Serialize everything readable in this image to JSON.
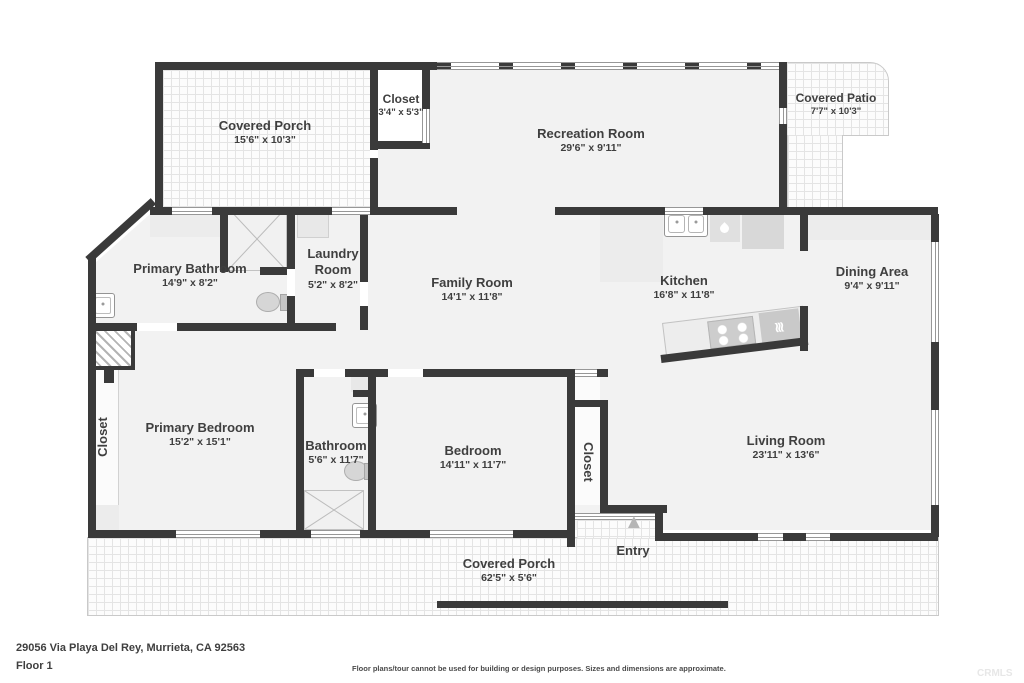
{
  "rooms": {
    "covered_porch_top": {
      "name": "Covered Porch",
      "dims": "15'6\" x 10'3\""
    },
    "closet_top": {
      "name": "Closet",
      "dims": "3'4\" x 5'3\""
    },
    "recreation_room": {
      "name": "Recreation Room",
      "dims": "29'6\" x 9'11\""
    },
    "covered_patio": {
      "name": "Covered Patio",
      "dims": "7'7\" x 10'3\""
    },
    "primary_bathroom": {
      "name": "Primary Bathroom",
      "dims": "14'9\" x 8'2\""
    },
    "laundry_room": {
      "name": "Laundry Room",
      "dims": "5'2\" x 8'2\""
    },
    "family_room": {
      "name": "Family Room",
      "dims": "14'1\" x 11'8\""
    },
    "kitchen": {
      "name": "Kitchen",
      "dims": "16'8\" x 11'8\""
    },
    "dining_area": {
      "name": "Dining Area",
      "dims": "9'4\" x 9'11\""
    },
    "closet_left": {
      "name": "Closet"
    },
    "primary_bedroom": {
      "name": "Primary Bedroom",
      "dims": "15'2\" x 15'1\""
    },
    "bathroom": {
      "name": "Bathroom",
      "dims": "5'6\" x 11'7\""
    },
    "bedroom": {
      "name": "Bedroom",
      "dims": "14'11\" x 11'7\""
    },
    "closet_bedroom": {
      "name": "Closet"
    },
    "living_room": {
      "name": "Living Room",
      "dims": "23'11\" x 13'6\""
    },
    "entry": {
      "name": "Entry"
    },
    "covered_porch_bottom": {
      "name": "Covered Porch",
      "dims": "62'5\" x 5'6\""
    }
  },
  "footer": {
    "address": "29056 Via Playa Del Rey, Murrieta, CA 92563",
    "floor_label": "Floor 1",
    "disclaimer": "Floor plans/tour cannot be used for building or design purposes. Sizes and dimensions are approximate.",
    "watermark": "CRMLS"
  },
  "icons": {
    "entry_arrow": "▲",
    "cooktop_waves": "≋"
  },
  "colors": {
    "wall": "#3a3a3a",
    "room_fill": "#f2f2f2",
    "label_text": "#3f3f3f"
  }
}
